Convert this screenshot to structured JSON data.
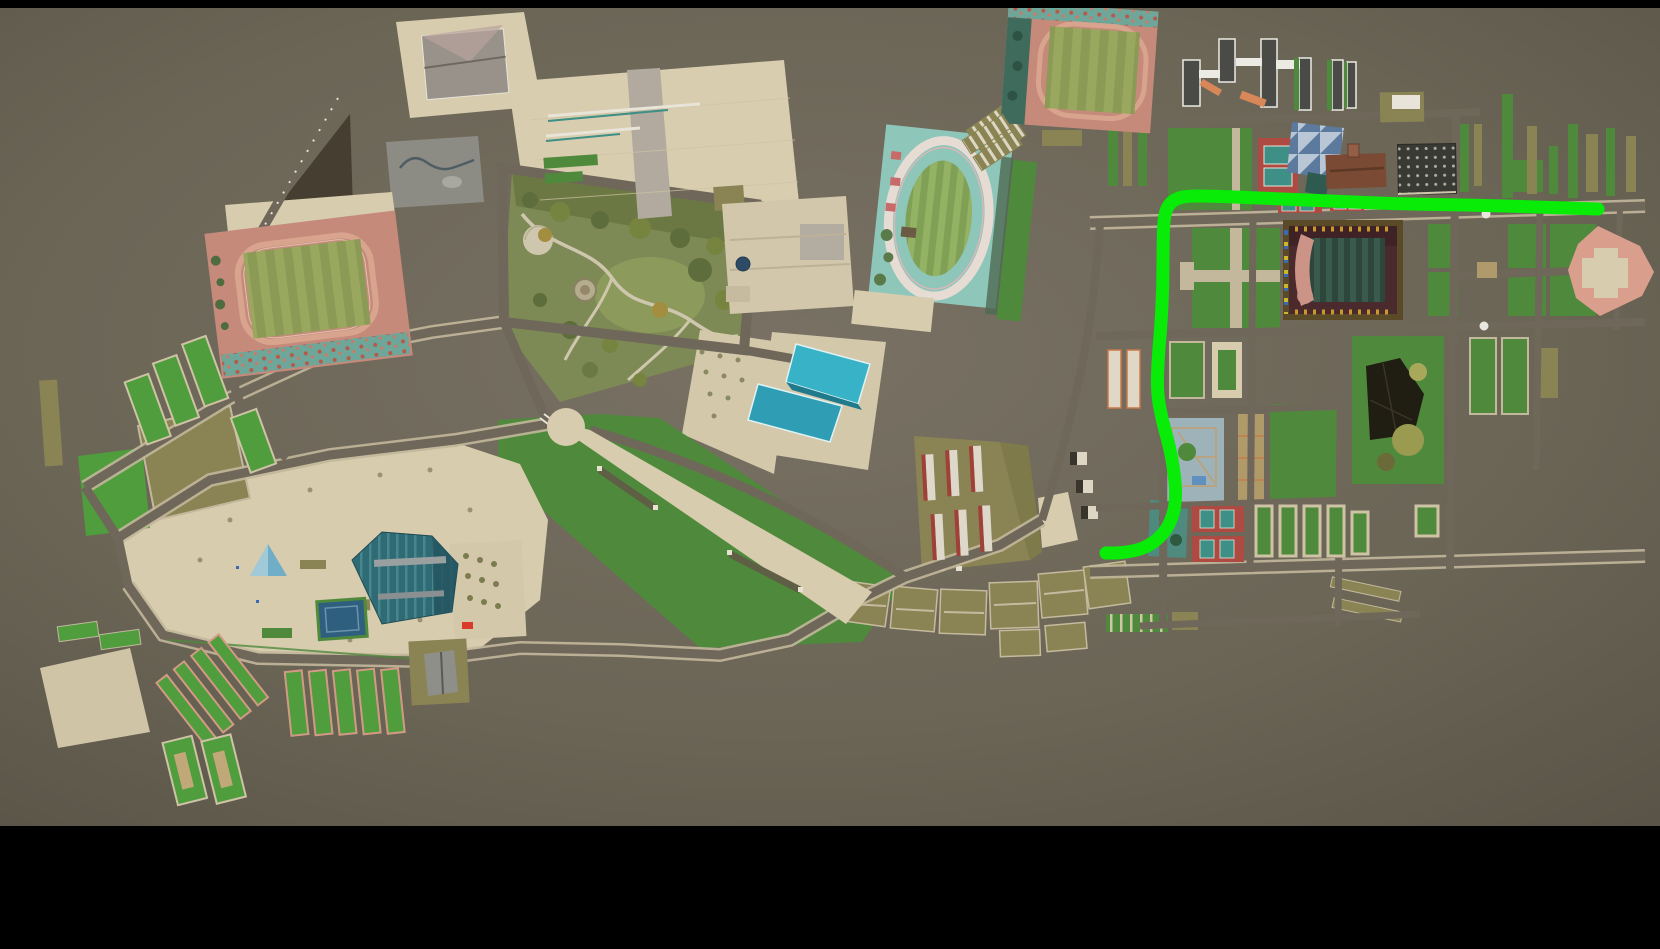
{
  "scene": {
    "kind": "aerial-3d-campus-map",
    "viewport": {
      "width": 1660,
      "height": 949
    },
    "letterbox_top_height": 8,
    "map_bottom": 826
  },
  "colors": {
    "background_center": "#787164",
    "background_mid": "#6b6556",
    "background_edge": "#5a5448",
    "letterbox": "#000000",
    "road": "#6f6759",
    "road_casing": "#c3b79c",
    "path_light": "#cfc6ae",
    "plaza": "#d8ccae",
    "lawn": "#4f8a3c",
    "lawn_bright": "#4f9d3d",
    "lawn_olive": "#7e8a55",
    "khaki": "#8a8354",
    "khaki_dark": "#7f7a4a",
    "forest": "#463f31",
    "track_pink": "#c58a7a",
    "track_lane": "#d8a48e",
    "field_stripe_a": "#9aa75f",
    "field_stripe_b": "#8b9a55",
    "mottle_teal": "#6fa69a",
    "mottle_red": "#b85848",
    "teal_deck": "#8fc6ba",
    "stadium_maroon": "#4a2a2c",
    "stadium_dark": "#3f2226",
    "stadium_field_a": "#3a5a4e",
    "stadium_field_b": "#2c463c",
    "stadium_track_pink": "#cc9486",
    "gold_tree": "#c89a2e",
    "court_red": "#ad4a42",
    "court_teal": "#3e8f85",
    "checker_light": "#b9c6d6",
    "checker_mid": "#7e98b8",
    "checker_dark": "#5c7a9e",
    "brown_building": "#7a4a34",
    "dark_building": "#3a3a34",
    "dot_light": "#b0b0a4",
    "white_slab": "#4a4a46",
    "slab_edge": "#ebebe4",
    "library_teal": "#38b2c6",
    "library_teal_dark": "#2f9db4",
    "gym_teal": "#2f6b74",
    "gym_rib": "#49858d",
    "gym_side": "#235560",
    "ridge_gray": "#9aa0a0",
    "pyramid_blue": "#6faec6",
    "pyramid_light": "#a0cad8",
    "fan_pink": "#d99e8c",
    "salmon_border": "#d29a84",
    "pool_blue": "#2e5f7e",
    "dome_blue": "#2e4b66",
    "auditorium_dark": "#201d12",
    "white": "#e8e4d8",
    "route": "#08ec08"
  },
  "route": {
    "color": "#08ec08",
    "stroke_width": 13,
    "points": [
      [
        1598,
        209
      ],
      [
        1540,
        207
      ],
      [
        1470,
        205
      ],
      [
        1400,
        204
      ],
      [
        1330,
        201
      ],
      [
        1260,
        198
      ],
      [
        1210,
        196
      ],
      [
        1183,
        196
      ],
      [
        1170,
        202
      ],
      [
        1164,
        215
      ],
      [
        1163,
        245
      ],
      [
        1163,
        285
      ],
      [
        1161,
        325
      ],
      [
        1158,
        360
      ],
      [
        1157,
        392
      ],
      [
        1162,
        420
      ],
      [
        1170,
        448
      ],
      [
        1175,
        478
      ],
      [
        1176,
        502
      ],
      [
        1171,
        522
      ],
      [
        1160,
        538
      ],
      [
        1143,
        549
      ],
      [
        1122,
        553
      ],
      [
        1106,
        553
      ]
    ]
  }
}
